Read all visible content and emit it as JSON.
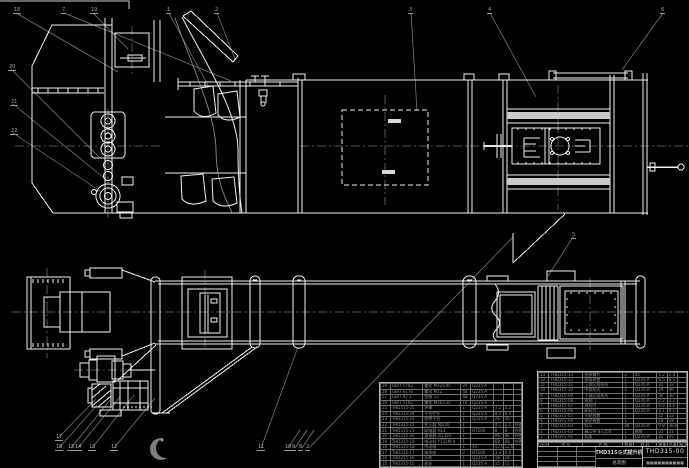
{
  "colors": {
    "background": "#000000",
    "line": "#f2f2f2",
    "leader": "#7d7d7d",
    "centerline": "#6f6f6f",
    "table_text": "#8f8f8f"
  },
  "title_block": {
    "product_title": "THD315斗式提升机",
    "drawing_type": "总装图",
    "drawing_number": "THD315-00",
    "company": "■■■■■■■■■■"
  },
  "bom": {
    "header": [
      "序号",
      "代  号",
      "名  称",
      "数量",
      "材  料",
      "单重",
      "总重",
      "备注"
    ],
    "right_rows": [
      [
        "13",
        "THD315-13",
        "张紧螺杆",
        "2",
        "45",
        "1.2",
        "2.4",
        ""
      ],
      [
        "12",
        "THD315-12",
        "张紧装置",
        "1",
        "Q235-A",
        "6.5",
        "6.5",
        ""
      ],
      [
        "11",
        "THD315-11",
        "上部区段机壳",
        "1",
        "Q235-A",
        "32",
        "32",
        ""
      ],
      [
        "10",
        "THD315-10",
        "中部机壳",
        "4",
        "Q235-A",
        "24",
        "96",
        ""
      ],
      [
        "9",
        "THD315-09",
        "下部区段机壳",
        "1",
        "Q235-A",
        "30",
        "30",
        ""
      ],
      [
        "8",
        "THD315-08",
        "观察门",
        "1",
        "Q235-A",
        "2.2",
        "2.2",
        ""
      ],
      [
        "7",
        "THD315-07",
        "进料口",
        "1",
        "Q235-A",
        "4.6",
        "4.6",
        ""
      ],
      [
        "6",
        "THD315-06",
        "卸料口",
        "1",
        "Q235-A",
        "4.1",
        "4.1",
        ""
      ],
      [
        "5",
        "THD315-05",
        "头轮装置",
        "1",
        "",
        "22",
        "22",
        ""
      ],
      [
        "4",
        "THD315-04",
        "尾轮装置",
        "1",
        "",
        "18",
        "18",
        ""
      ],
      [
        "3",
        "THD315-03",
        "料斗",
        "46",
        "Q235-A",
        "0.8",
        "36.8",
        ""
      ],
      [
        "2",
        "THD315-02",
        "畚斗带 B=250",
        "1",
        "橡胶",
        "21",
        "21",
        ""
      ],
      [
        "1",
        "THD315-01",
        "机架",
        "1",
        "Q235-A",
        "45",
        "45",
        ""
      ]
    ],
    "left_rows": [
      [
        "29",
        "GB/T 5782",
        "螺栓 M12×45",
        "24",
        "Q235-A",
        "",
        "",
        ""
      ],
      [
        "28",
        "GB/T 6170",
        "螺母 M12",
        "48",
        "Q235-A",
        "",
        "",
        ""
      ],
      [
        "27",
        "GB/T 97.1",
        "垫圈 12",
        "48",
        "Q235-A",
        "",
        "",
        ""
      ],
      [
        "26",
        "GB/T 5782",
        "螺栓 M10×35",
        "16",
        "Q235-A",
        "",
        "",
        ""
      ],
      [
        "25",
        "THD315-25",
        "护罩",
        "1",
        "Q235-A",
        "3.2",
        "3.2",
        ""
      ],
      [
        "24",
        "THD315-24",
        "平台栏杆",
        "1",
        "Q235-A",
        "8.5",
        "8.5",
        ""
      ],
      [
        "23",
        "THD315-23",
        "检修平台",
        "1",
        "Q235-A",
        "26",
        "26",
        ""
      ],
      [
        "22",
        "THD315-22",
        "逆止器 NJ230",
        "1",
        "",
        "4.1",
        "4.1",
        "外购"
      ],
      [
        "21",
        "THD315-21",
        "联轴器 HL3",
        "1",
        "HT200",
        "8",
        "8",
        "外购"
      ],
      [
        "20",
        "THD315-20",
        "减速器 ZQ350",
        "1",
        "",
        "96",
        "96",
        "外购"
      ],
      [
        "19",
        "THD315-19",
        "电动机 Y132M-4",
        "1",
        "",
        "68",
        "68",
        "外购"
      ],
      [
        "18",
        "THD315-18",
        "传动轴",
        "1",
        "45",
        "12.6",
        "12.6",
        ""
      ],
      [
        "17",
        "THD315-17",
        "轴承座",
        "2",
        "HT200",
        "3.4",
        "6.8",
        ""
      ],
      [
        "16",
        "THD315-16",
        "头轮",
        "1",
        "Q235-A",
        "18",
        "18",
        ""
      ],
      [
        "15",
        "THD315-15",
        "尾轮",
        "1",
        "Q235-A",
        "15",
        "15",
        ""
      ]
    ]
  },
  "balloon_labels": [
    "18",
    "7",
    "19",
    "1",
    "2",
    "3",
    "4",
    "6",
    "20",
    "21",
    "22",
    "5",
    "17",
    "16",
    "15",
    "14",
    "13",
    "12",
    "11",
    "10",
    "9",
    "8",
    "2"
  ]
}
